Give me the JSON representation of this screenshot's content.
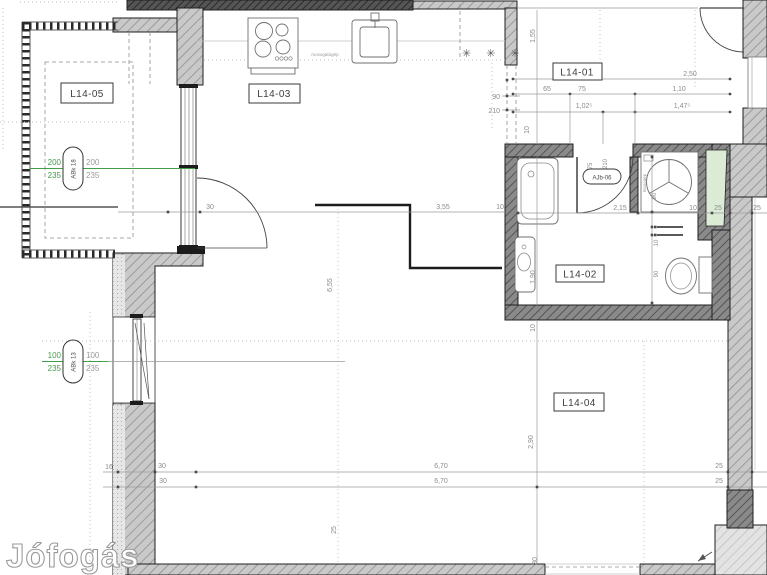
{
  "watermark": "Jófogás",
  "rooms": {
    "r05": "L14-05",
    "r03": "L14-03",
    "r01": "L14-01",
    "r02": "L14-02",
    "r04": "L14-04"
  },
  "tags": {
    "abk18": {
      "id": "ABk 18",
      "gw": "200",
      "gh": "235",
      "w": "200",
      "h": "235"
    },
    "abk13": {
      "id": "ABk 13",
      "gw": "100",
      "gh": "235",
      "w": "100",
      "h": "235"
    },
    "ajb06": {
      "id": "AJb-06",
      "w": "75",
      "h": "210"
    }
  },
  "kitchen": {
    "dishwasher": "mosogatógép",
    "fridge": "✳ ✳ ✳"
  },
  "bath": {
    "washer": "mosógép",
    "width": "2,15",
    "tub": "1,90",
    "wm": "90",
    "rail": "10",
    "wc": "90"
  },
  "hall": {
    "total": "2,50",
    "a": "65",
    "b": "75",
    "c": "1,10",
    "d": "1,02⁵",
    "e": "1,47⁵",
    "pass_w": "90",
    "pass_h": "210",
    "height": "1,55",
    "ten": "10"
  },
  "chain_h": {
    "door": "30",
    "main": "3,55",
    "t1": "10",
    "t2": "10",
    "t3": "25",
    "t4": "25"
  },
  "chain_v": {
    "len": "6,55",
    "a": "25",
    "b": "10",
    "c": "2,90",
    "d": "30"
  },
  "bottom": {
    "a": "16",
    "b": "30",
    "c": "30",
    "d": "6,70",
    "e": "6,70",
    "f": "25",
    "g": "25"
  },
  "colors": {
    "green": "#3fa048",
    "shaft_fill": "#dcebd6",
    "dim_text": "#8b8b8b"
  }
}
